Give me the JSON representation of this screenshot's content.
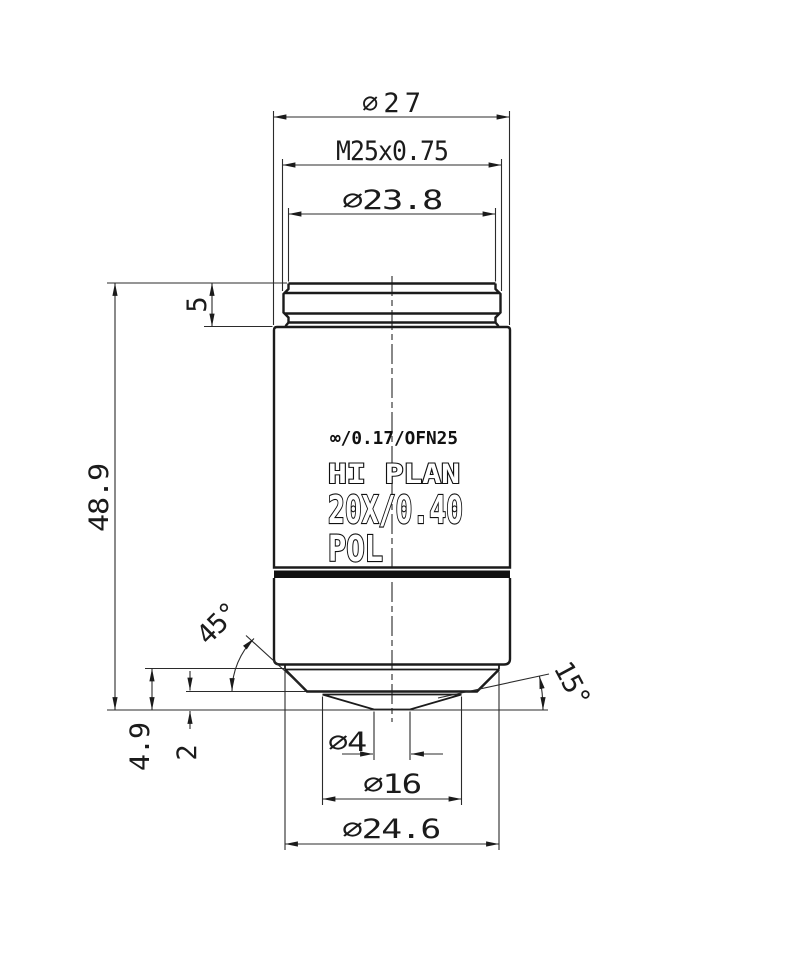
{
  "engraving": {
    "line1": "∞/0.17/OFN25",
    "line2": "HI PLAN",
    "line3": "20X/0.40",
    "line4": "POL"
  },
  "dimensions": {
    "outer_diameter": "∅27",
    "mount_thread": "M25x0.75",
    "thread_collar_diameter": "∅23.8",
    "thread_length": "5",
    "overall_length": "48.9",
    "nose_length": "4.9",
    "front_recess": "2",
    "front_lens_diameter": "∅4",
    "front_face_diameter": "∅16",
    "nose_base_diameter": "∅24.6",
    "chamfer_angle": "45°",
    "nose_cone_angle": "15°"
  },
  "colors": {
    "background": "#ffffff",
    "line": "#1b1b1b",
    "engraving_fill": "#ffffff"
  }
}
